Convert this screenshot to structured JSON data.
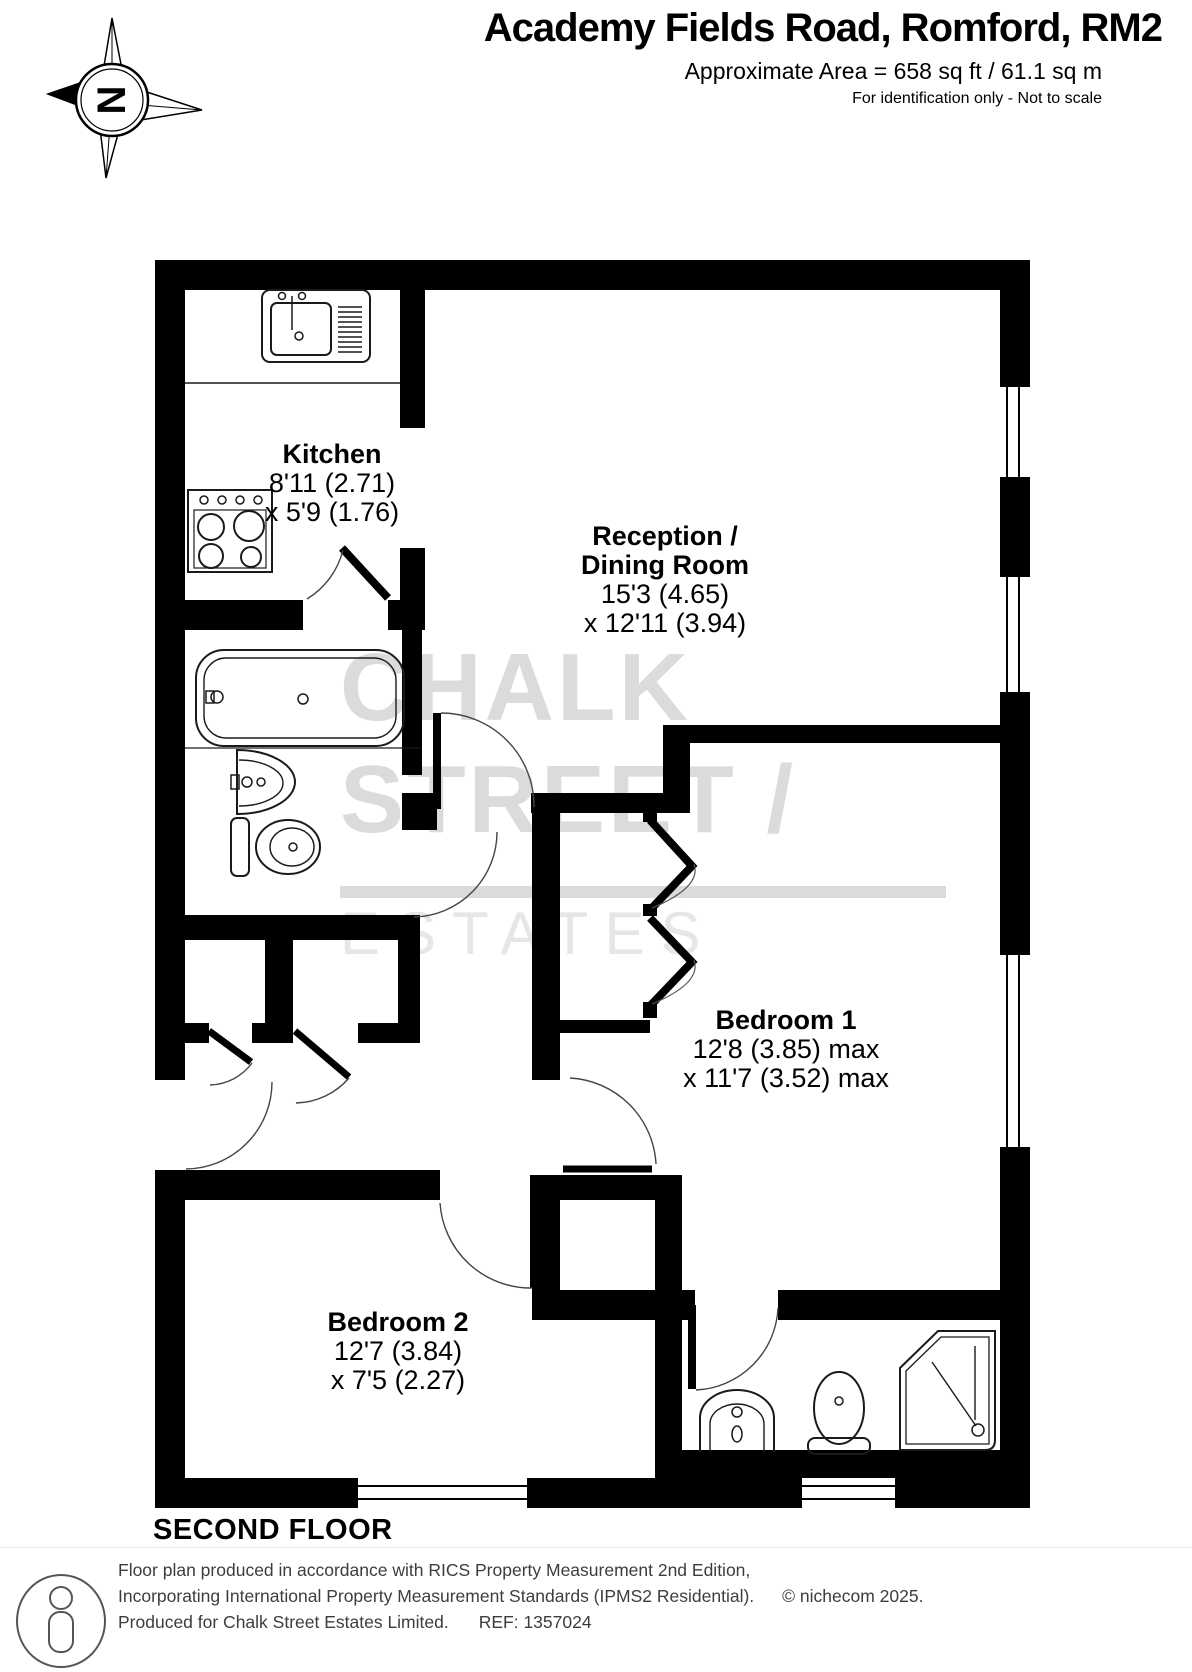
{
  "header": {
    "title": "Academy Fields Road, Romford, RM2",
    "area": "Approximate Area = 658 sq ft / 61.1 sq m",
    "disclaimer": "For identification only - Not to scale"
  },
  "compass": {
    "letter": "N"
  },
  "watermark": {
    "word1": "CHALK",
    "word2": "STREET /",
    "word3": "ESTATES"
  },
  "rooms": {
    "kitchen": {
      "name": "Kitchen",
      "dim1": "8'11 (2.71)",
      "dim2": "x 5'9 (1.76)"
    },
    "reception": {
      "name1": "Reception /",
      "name2": "Dining Room",
      "dim1": "15'3 (4.65)",
      "dim2": "x 12'11 (3.94)"
    },
    "bedroom1": {
      "name": "Bedroom 1",
      "dim1": "12'8 (3.85) max",
      "dim2": "x 11'7 (3.52) max"
    },
    "bedroom2": {
      "name": "Bedroom 2",
      "dim1": "12'7 (3.84)",
      "dim2": "x 7'5 (2.27)"
    }
  },
  "floor_label": "SECOND FLOOR",
  "footer": {
    "line1": "Floor plan produced in accordance with RICS Property Measurement 2nd Edition,",
    "line2": "Incorporating International Property Measurement Standards (IPMS2 Residential).",
    "copyright": "© nichecom 2025.",
    "produced": "Produced for Chalk Street Estates Limited.",
    "ref": "REF: 1357024"
  }
}
